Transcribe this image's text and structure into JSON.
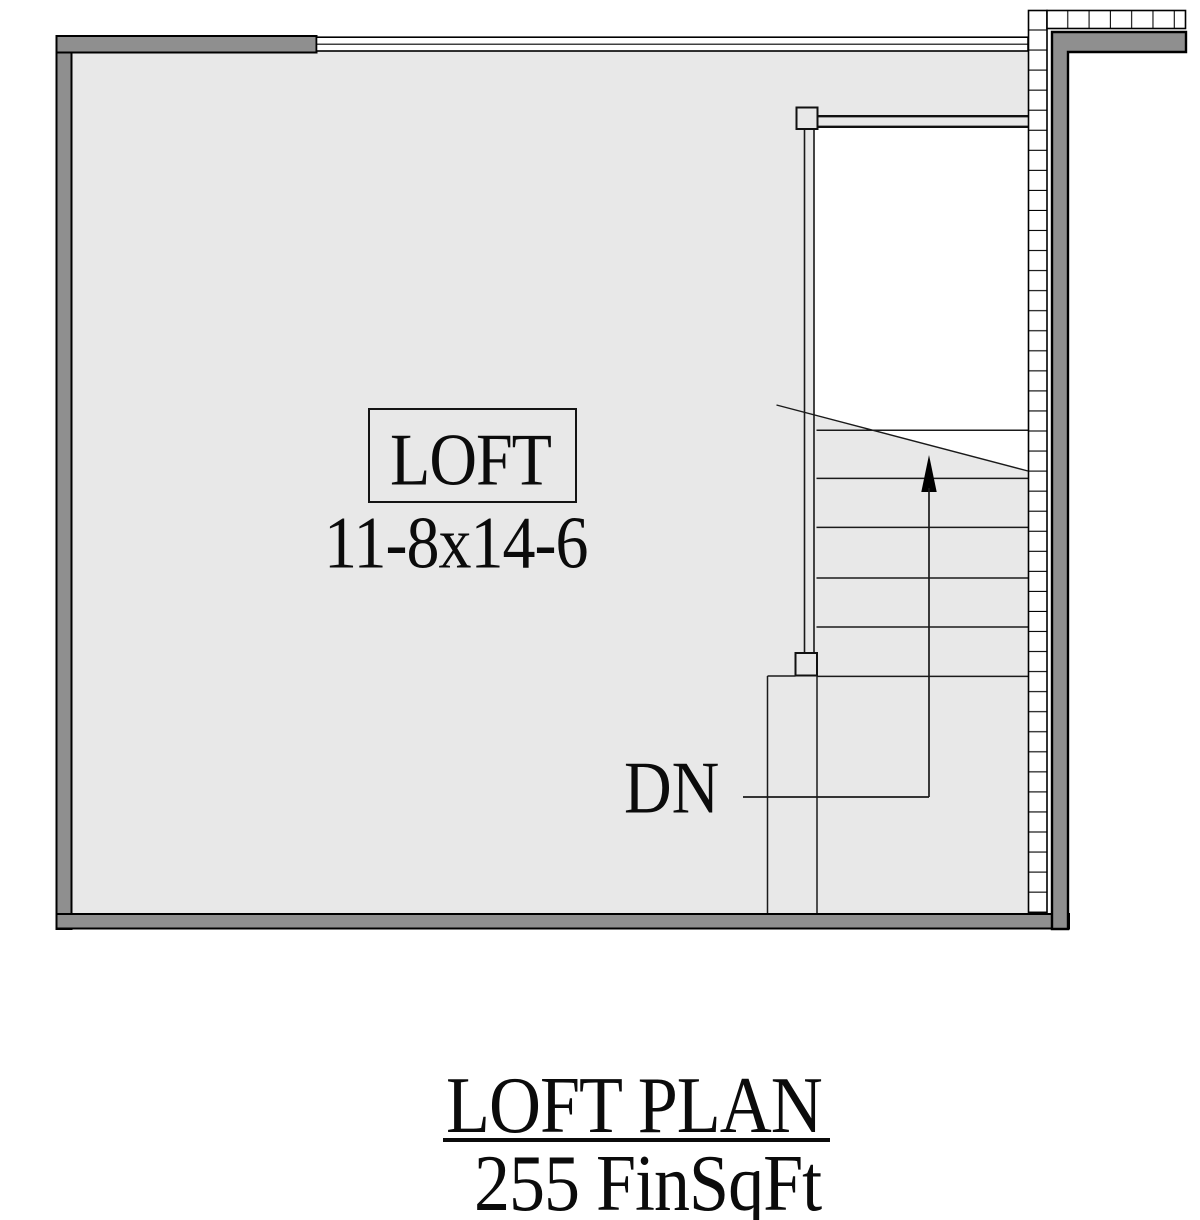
{
  "plan": {
    "room": {
      "name": "LOFT",
      "dimensions": "11-8x14-6"
    },
    "stairs": {
      "direction_label": "DN"
    },
    "title_block": {
      "title": "LOFT PLAN",
      "area": "255 FinSqFt"
    }
  },
  "colors": {
    "wall": "#8f8f8f",
    "floor": "#e8e8e8",
    "opening": "#ffffff",
    "line": "#000000"
  }
}
